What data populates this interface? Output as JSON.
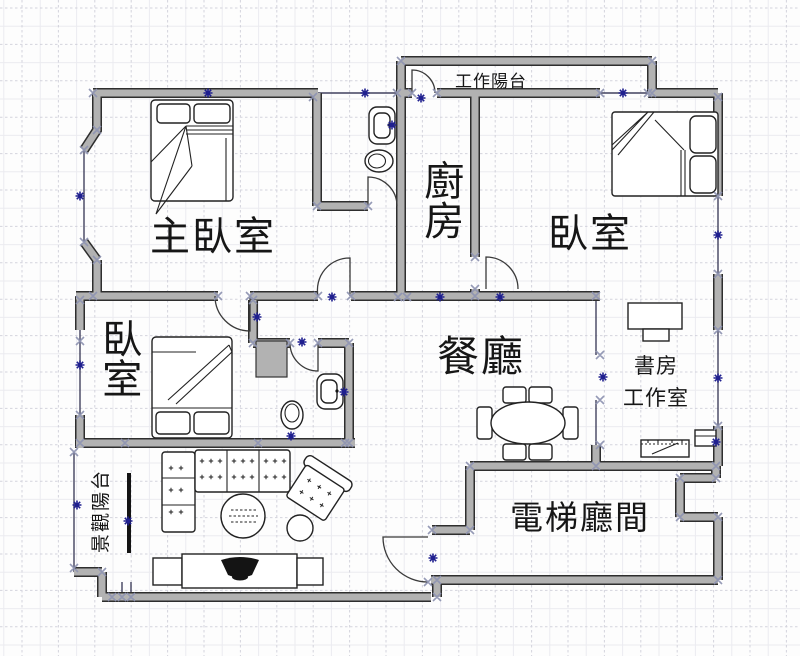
{
  "app": {
    "view": "floor-plan-editor"
  },
  "rooms": {
    "master_bedroom": {
      "label": "主臥室"
    },
    "kitchen": {
      "label": "廚房"
    },
    "bedroom_right": {
      "label": "臥室"
    },
    "bedroom_left": {
      "label": "臥室"
    },
    "dining_room": {
      "label": "餐廳"
    },
    "study_line1": {
      "label": "書房"
    },
    "study_line2": {
      "label": "工作室"
    },
    "work_balcony": {
      "label": "工作陽台"
    },
    "view_balcony": {
      "label": "景觀陽台"
    },
    "elevator_hall": {
      "label": "電梯廳間"
    }
  },
  "colors": {
    "background": "#fdfdfd",
    "grid_major": "#c9c9d4",
    "grid_minor": "#ebebf0",
    "wall_fill": "#b2b2b2",
    "wall_outline": "#2e2e2e",
    "window_line": "#42425e",
    "selection_handle": "#8f95b2",
    "connection_point": "#20208f",
    "furniture_stroke": "#222222",
    "tv_fill": "#141414",
    "label_text": "#161616"
  }
}
